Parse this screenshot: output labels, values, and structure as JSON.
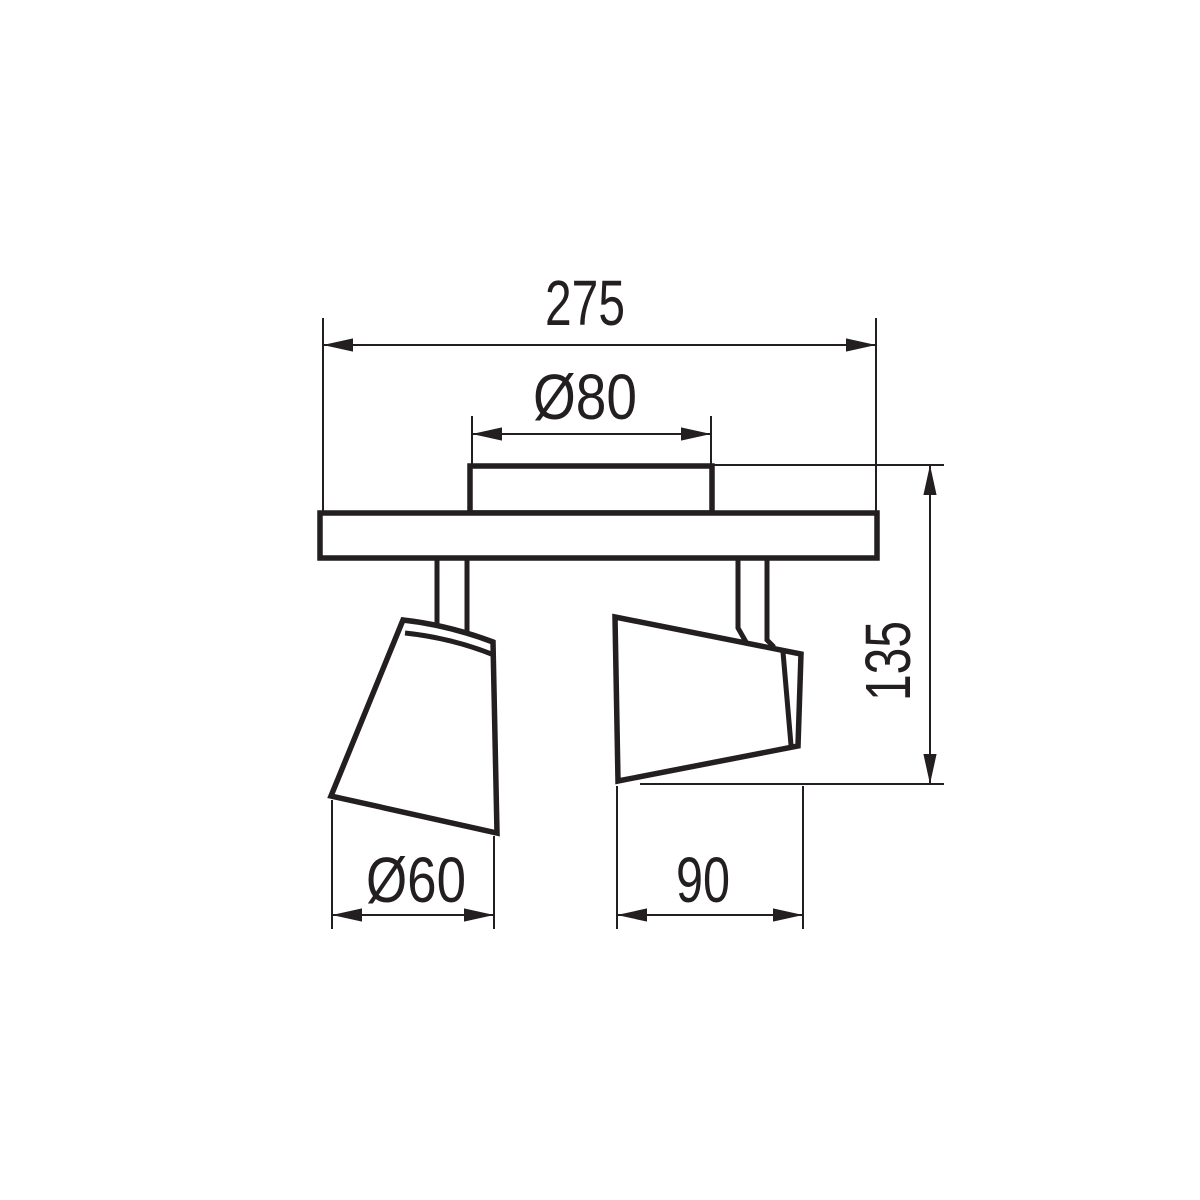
{
  "colors": {
    "line": "#231f20",
    "background": "#ffffff"
  },
  "dimensions": {
    "overall_width": "275",
    "canopy_diameter": "Ø80",
    "total_height": "135",
    "left_shade_diameter": "Ø60",
    "right_shade_length": "90"
  }
}
